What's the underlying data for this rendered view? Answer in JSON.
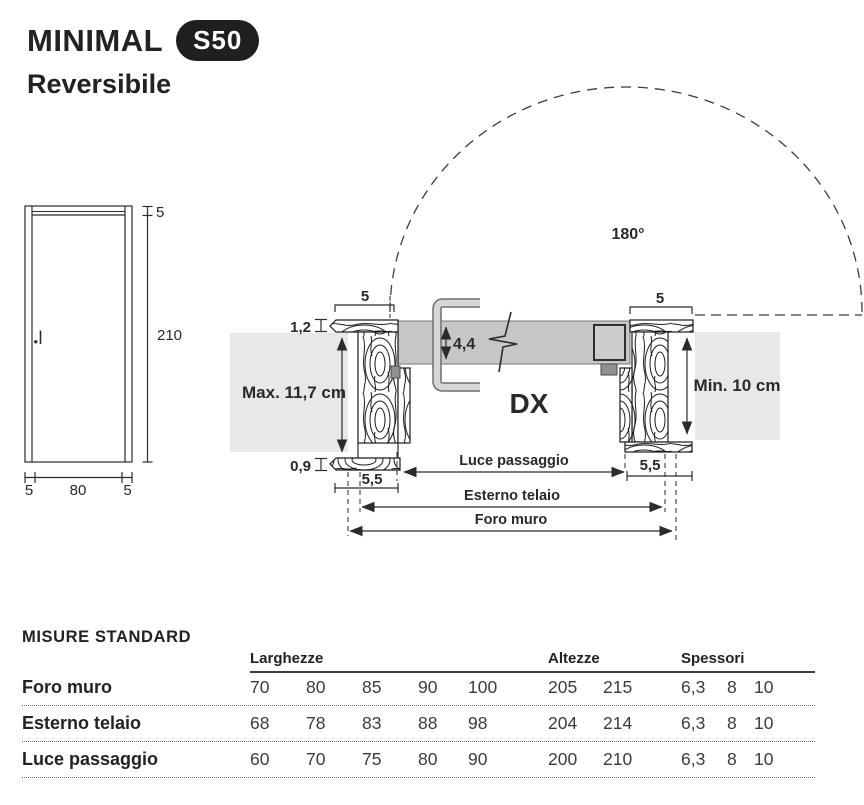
{
  "header": {
    "title": "MINIMAL",
    "badge": "S50",
    "subtitle": "Reversibile"
  },
  "elevation": {
    "frame_top": "5",
    "height": "210",
    "frame_left": "5",
    "width": "80",
    "frame_right": "5"
  },
  "plan": {
    "swing_angle": "180°",
    "jamb_width_left": "5",
    "jamb_width_right": "5",
    "architrave_top": "1,2",
    "architrave_bottom": "0,9",
    "leaf_thickness": "4,4",
    "hand": "DX",
    "wall_max": "Max. 11,7 cm",
    "wall_min": "Min. 10 cm",
    "casing_left": "5,5",
    "casing_right": "5,5",
    "dim_luce": "Luce passaggio",
    "dim_esterno": "Esterno telaio",
    "dim_foro": "Foro muro"
  },
  "table": {
    "title": "MISURE STANDARD",
    "groups": [
      "Larghezze",
      "Altezze",
      "Spessori"
    ],
    "rows": [
      {
        "label": "Foro muro",
        "larghezze": [
          "70",
          "80",
          "85",
          "90",
          "100"
        ],
        "altezze": [
          "205",
          "215"
        ],
        "spessori": [
          "6,3",
          "8",
          "10"
        ]
      },
      {
        "label": "Esterno telaio",
        "larghezze": [
          "68",
          "78",
          "83",
          "88",
          "98"
        ],
        "altezze": [
          "204",
          "214"
        ],
        "spessori": [
          "6,3",
          "8",
          "10"
        ]
      },
      {
        "label": "Luce passaggio",
        "larghezze": [
          "60",
          "70",
          "75",
          "80",
          "90"
        ],
        "altezze": [
          "200",
          "210"
        ],
        "spessori": [
          "6,3",
          "8",
          "10"
        ]
      }
    ]
  },
  "colors": {
    "badge_bg": "#211f1d",
    "wall_gray": "#e8e8e8",
    "leaf_gray": "#c6c6c8"
  }
}
